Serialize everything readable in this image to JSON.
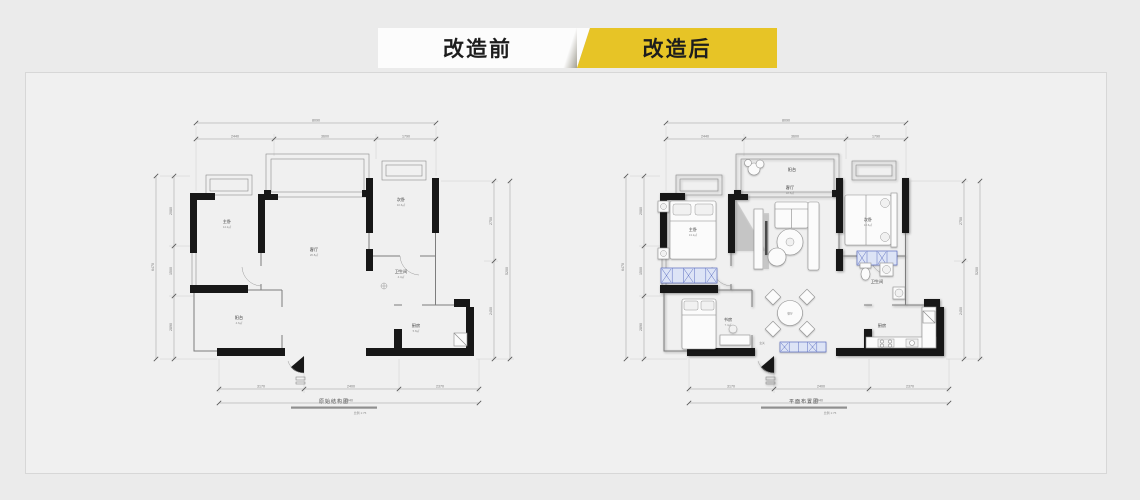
{
  "tabs": {
    "before": "改造前",
    "after": "改造后"
  },
  "colors": {
    "accent_yellow": "#e7c426",
    "panel_bg": "#f0f0f0",
    "wall": "#171717",
    "wardrobe_blue": "#5a6cc0"
  },
  "dims": {
    "top_total": "8090",
    "top_segments": [
      "2440",
      "3600",
      "1790"
    ],
    "left_total": "6470",
    "left_segments": [
      "2080",
      "1500",
      "2890"
    ],
    "right_total": "5200",
    "right_segments": [
      "2750",
      "2450"
    ],
    "bottom_total": "7940",
    "bottom_segments": [
      "3170",
      "2400",
      "2370"
    ],
    "scale_label": "比例 1:75"
  },
  "plans": {
    "before": {
      "caption": "原始结构图",
      "rooms": [
        {
          "name": "主卧",
          "area": "14.2㎡"
        },
        {
          "name": "客厅",
          "area": "26.8㎡"
        },
        {
          "name": "次卧",
          "area": "10.6㎡"
        },
        {
          "name": "卫生间",
          "area": "4.3㎡"
        },
        {
          "name": "厨房",
          "area": "5.8㎡"
        },
        {
          "name": "阳台",
          "area": "4.6㎡"
        }
      ]
    },
    "after": {
      "caption": "平面布置图",
      "rooms": [
        {
          "name": "主卧",
          "area": "13.2㎡"
        },
        {
          "name": "阳台",
          "area": "4.6㎡"
        },
        {
          "name": "客厅",
          "area": "18.5㎡"
        },
        {
          "name": "餐厅",
          "area": "6.1㎡"
        },
        {
          "name": "次卧",
          "area": "10.6㎡"
        },
        {
          "name": "卫生间",
          "area": "4.3㎡"
        },
        {
          "name": "厨房",
          "area": "5.8㎡"
        },
        {
          "name": "书房",
          "area": "7.4㎡"
        },
        {
          "name": "玄关",
          "area": ""
        }
      ]
    }
  }
}
